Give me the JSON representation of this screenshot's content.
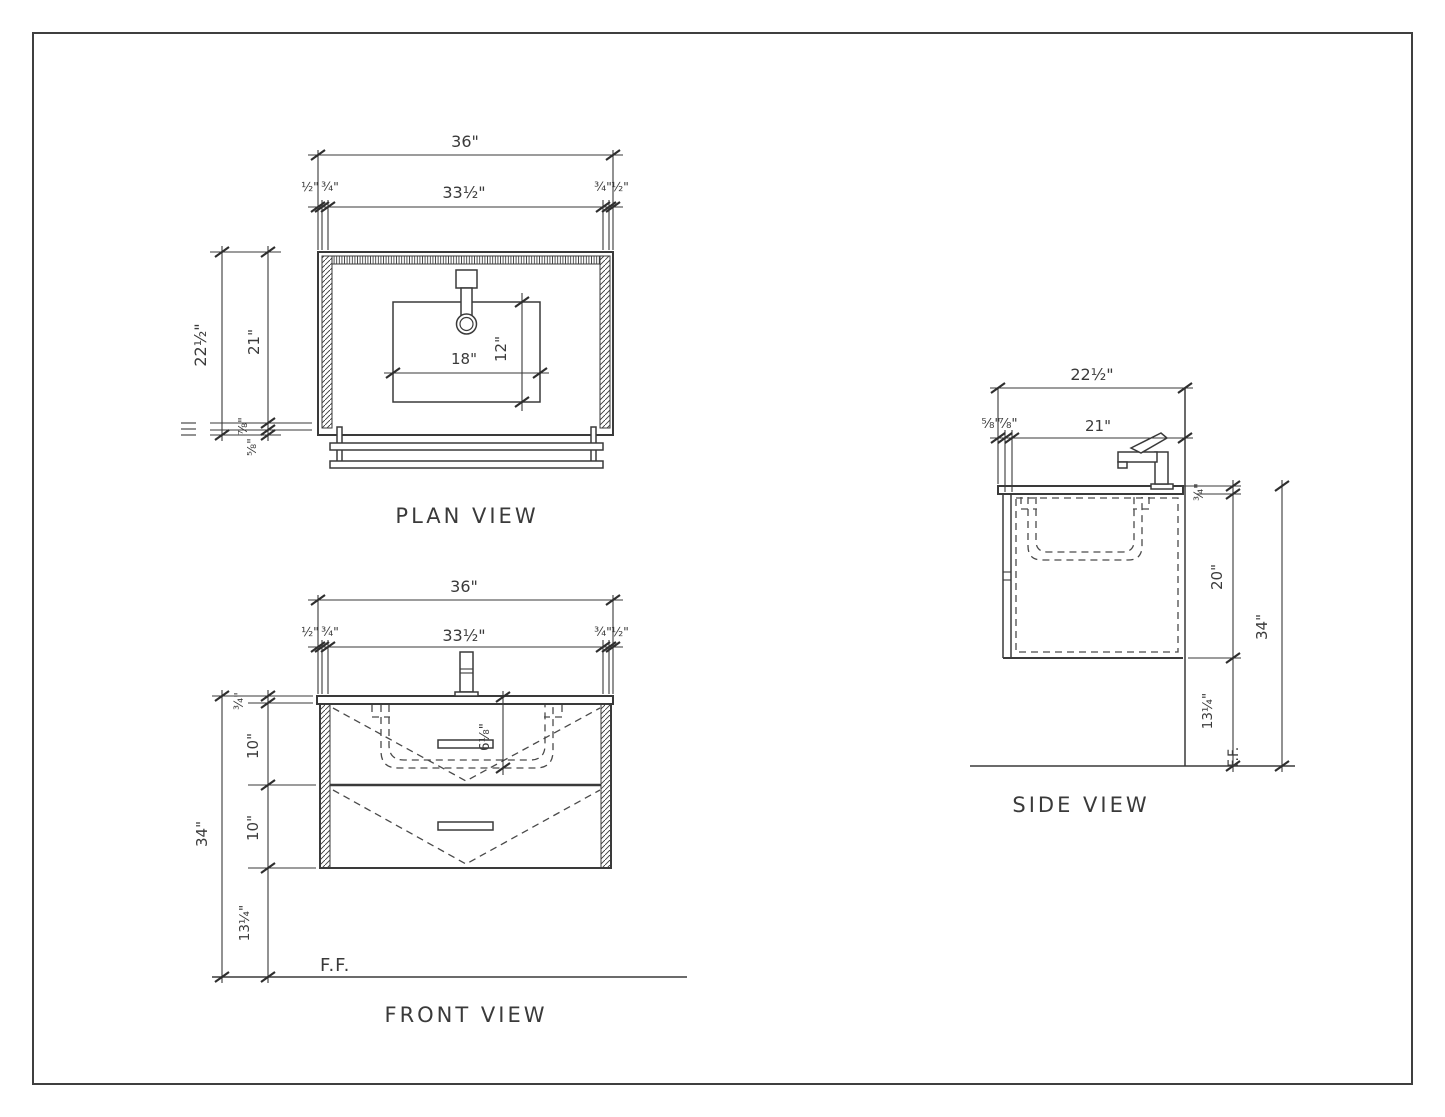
{
  "colors": {
    "line": "#3a3a3a",
    "background": "#ffffff"
  },
  "views": {
    "plan": {
      "title": "PLAN VIEW",
      "dims": {
        "overall_width": "36\"",
        "reveal_left": "½\"",
        "panel_left": "¾\"",
        "inner_width": "33½\"",
        "panel_right": "¾\"",
        "reveal_right": "½\"",
        "overall_depth": "22½\"",
        "inner_depth": "21\"",
        "front_panel": "⅞\"",
        "front_reveal": "⅝\"",
        "sink_cutout_width": "18\"",
        "sink_cutout_depth": "12\""
      }
    },
    "front": {
      "title": "FRONT VIEW",
      "dims": {
        "overall_width": "36\"",
        "reveal_left": "½\"",
        "panel_left": "¾\"",
        "inner_width": "33½\"",
        "panel_right": "¾\"",
        "reveal_right": "½\"",
        "countertop_thickness": "¾\"",
        "drawer1_height": "10\"",
        "drawer2_height": "10\"",
        "mounting_height": "13¼\"",
        "overall_height": "34\"",
        "sink_depth": "6⅛\"",
        "finished_floor": "F.F."
      }
    },
    "side": {
      "title": "SIDE VIEW",
      "dims": {
        "overall_depth": "22½\"",
        "back_reveal": "⅝\"",
        "back_panel": "⅞\"",
        "inner_depth": "21\"",
        "countertop_thickness": "¾\"",
        "cabinet_height": "20\"",
        "mounting_height": "13¼\"",
        "overall_height": "34\"",
        "finished_floor": "F.F."
      }
    }
  }
}
